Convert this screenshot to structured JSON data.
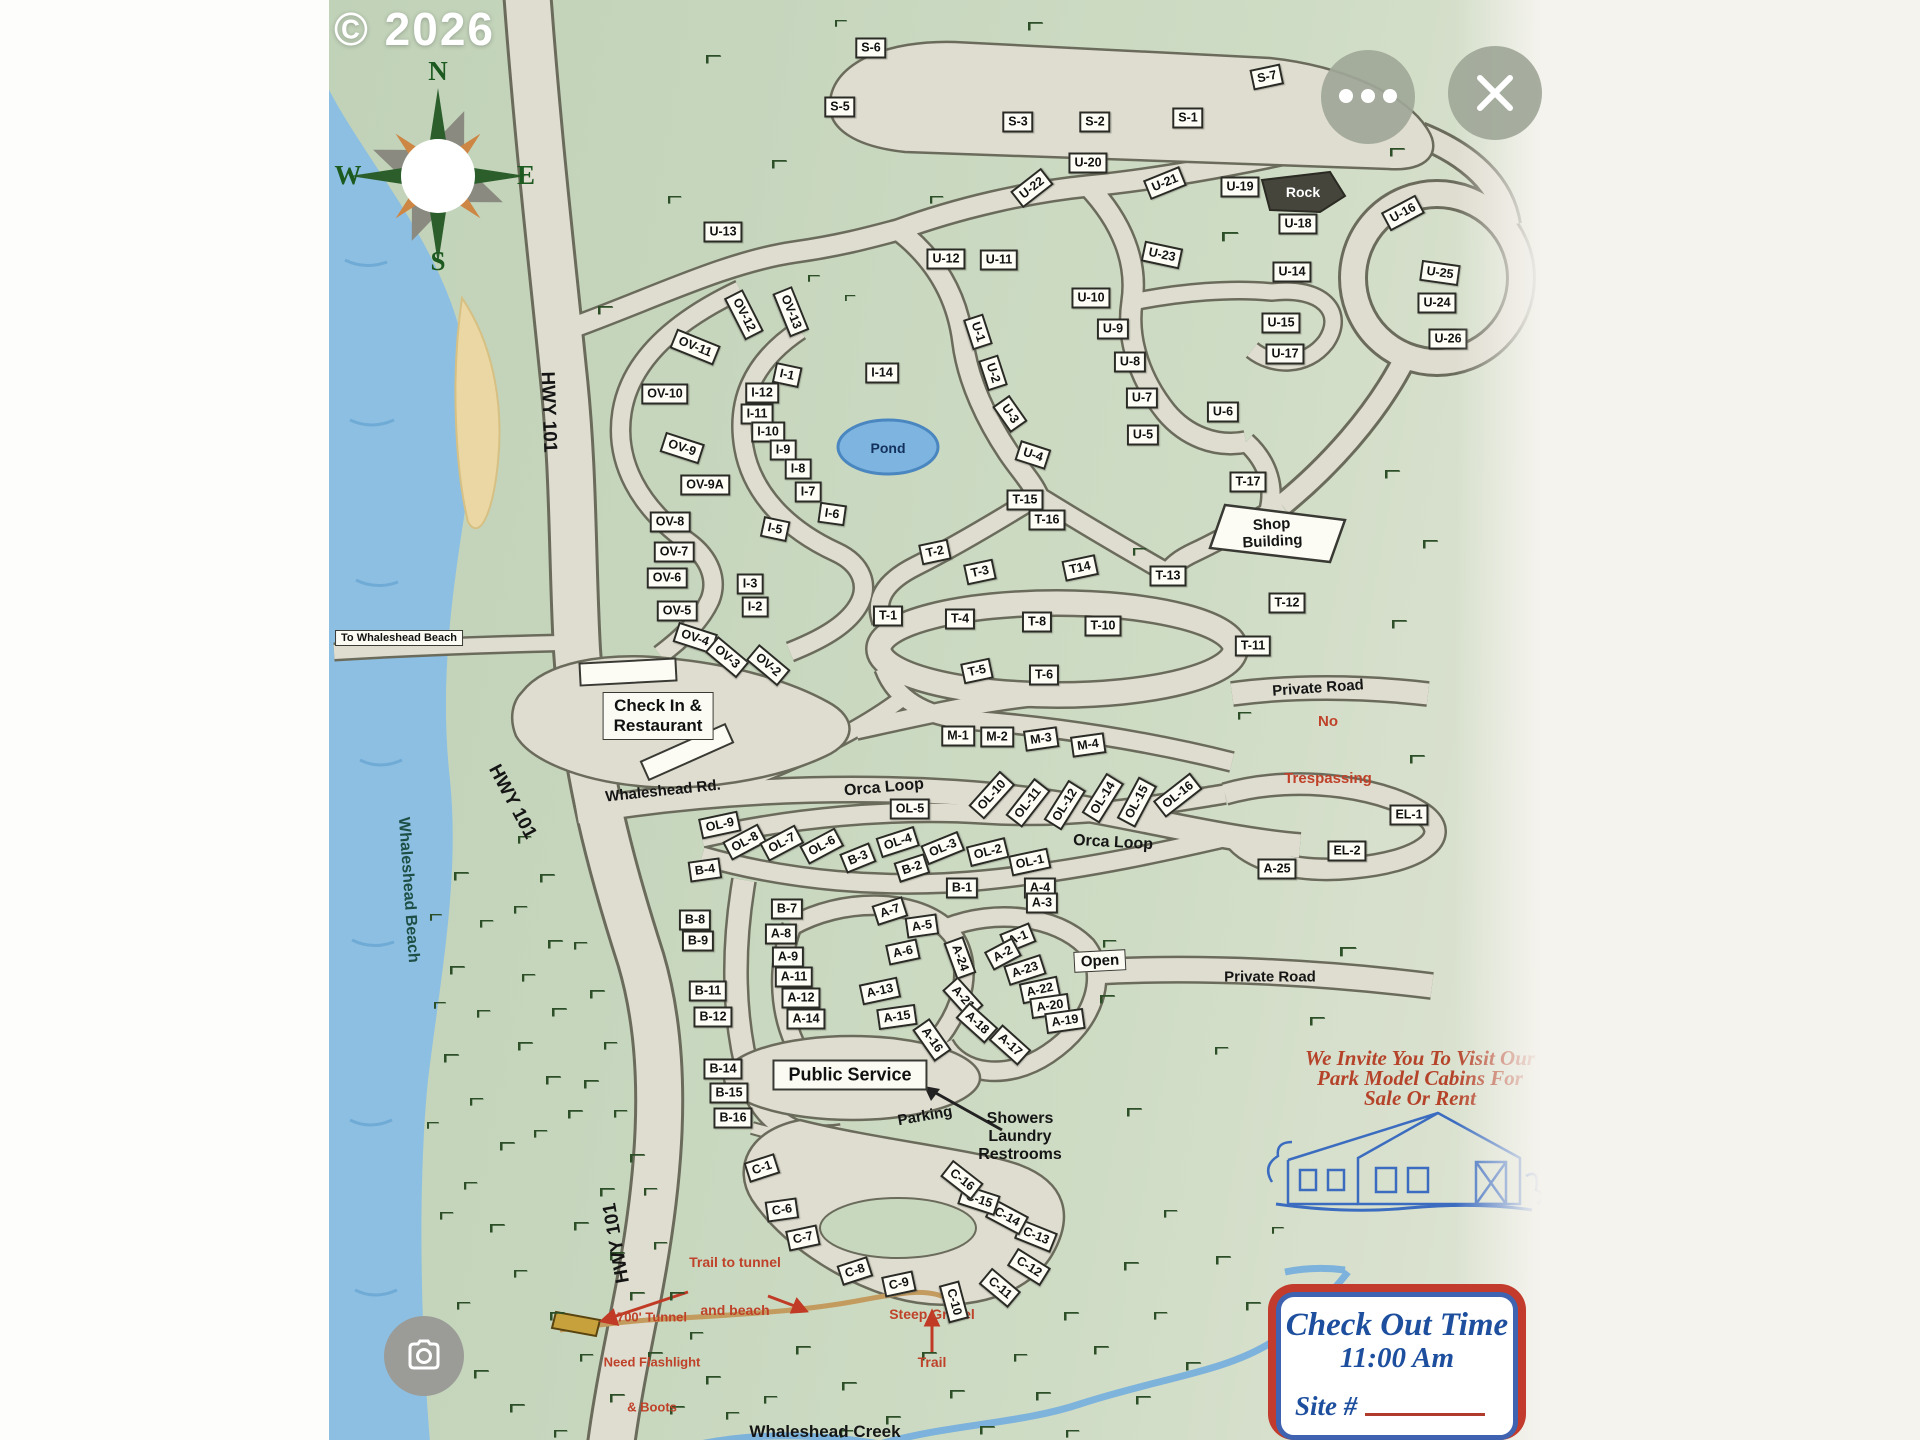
{
  "watermark": "© 2026",
  "compass": {
    "n": "N",
    "e": "E",
    "s": "S",
    "w": "W"
  },
  "labels": {
    "hwy101_a": "HWY 101",
    "hwy101_b": "HWY 101",
    "hwy101_c": "HWY 101",
    "to_beach": "To Whaleshead Beach",
    "beach": "Whaleshead Beach",
    "whaleshead_rd": "Whaleshead Rd.",
    "orca_loop_a": "Orca Loop",
    "orca_loop_b": "Orca Loop",
    "pond": "Pond",
    "rock": "Rock",
    "private_road_a": "Private Road",
    "private_road_b": "Private Road",
    "open": "Open",
    "parking": "Parking",
    "public_service": "Public Service",
    "creek": "Whaleshead Creek",
    "checkin_lines": [
      "Check In &",
      "Restaurant"
    ],
    "shop_lines": [
      "Shop",
      "Building"
    ],
    "no_trespassing_lines": [
      "No",
      "Trespassing"
    ],
    "showers_lines": [
      "Showers",
      "Laundry",
      "Restrooms"
    ],
    "trail_lines": [
      "Trail to tunnel",
      "and beach"
    ],
    "tunnel_lines": [
      "700' Tunnel",
      "Need Flashlight",
      "& Boots"
    ],
    "steep_lines": [
      "Steep Gravel",
      "Trail"
    ],
    "invite_lines": [
      "We Invite You To Visit Our",
      "Park Model Cabins For",
      "Sale Or Rent"
    ],
    "checkout_title": "Check Out Time",
    "checkout_time": "11:00 Am",
    "site_no": "Site #"
  },
  "sites": [
    {
      "l": "S-6",
      "x": 871,
      "y": 48
    },
    {
      "l": "S-5",
      "x": 840,
      "y": 107
    },
    {
      "l": "S-3",
      "x": 1018,
      "y": 122
    },
    {
      "l": "S-2",
      "x": 1095,
      "y": 122
    },
    {
      "l": "S-1",
      "x": 1188,
      "y": 118
    },
    {
      "l": "S-7",
      "x": 1267,
      "y": 77,
      "r": -12
    },
    {
      "l": "U-20",
      "x": 1088,
      "y": 163
    },
    {
      "l": "U-22",
      "x": 1032,
      "y": 188,
      "r": -38
    },
    {
      "l": "U-21",
      "x": 1165,
      "y": 183,
      "r": -22
    },
    {
      "l": "U-19",
      "x": 1240,
      "y": 187
    },
    {
      "l": "U-18",
      "x": 1298,
      "y": 224
    },
    {
      "l": "U-16",
      "x": 1403,
      "y": 213,
      "r": -28
    },
    {
      "l": "U-13",
      "x": 723,
      "y": 232
    },
    {
      "l": "U-12",
      "x": 946,
      "y": 259
    },
    {
      "l": "U-11",
      "x": 999,
      "y": 260
    },
    {
      "l": "U-23",
      "x": 1162,
      "y": 255,
      "r": 12
    },
    {
      "l": "U-14",
      "x": 1292,
      "y": 272
    },
    {
      "l": "U-25",
      "x": 1440,
      "y": 273,
      "r": 8
    },
    {
      "l": "U-10",
      "x": 1091,
      "y": 298
    },
    {
      "l": "U-24",
      "x": 1437,
      "y": 303
    },
    {
      "l": "U-15",
      "x": 1281,
      "y": 323
    },
    {
      "l": "U-9",
      "x": 1113,
      "y": 329
    },
    {
      "l": "U-26",
      "x": 1448,
      "y": 339
    },
    {
      "l": "U-1",
      "x": 978,
      "y": 332,
      "r": 72
    },
    {
      "l": "U-17",
      "x": 1285,
      "y": 354
    },
    {
      "l": "U-8",
      "x": 1130,
      "y": 362
    },
    {
      "l": "U-2",
      "x": 993,
      "y": 373,
      "r": 72
    },
    {
      "l": "U-7",
      "x": 1142,
      "y": 398
    },
    {
      "l": "U-3",
      "x": 1010,
      "y": 414,
      "r": 55
    },
    {
      "l": "U-6",
      "x": 1223,
      "y": 412
    },
    {
      "l": "U-5",
      "x": 1143,
      "y": 435
    },
    {
      "l": "U-4",
      "x": 1033,
      "y": 455,
      "r": 18
    },
    {
      "l": "OV-12",
      "x": 744,
      "y": 315,
      "r": 63
    },
    {
      "l": "OV-13",
      "x": 791,
      "y": 312,
      "r": 68
    },
    {
      "l": "OV-11",
      "x": 695,
      "y": 347,
      "r": 22
    },
    {
      "l": "OV-10",
      "x": 665,
      "y": 394
    },
    {
      "l": "OV-9",
      "x": 682,
      "y": 448,
      "r": 18
    },
    {
      "l": "OV-9A",
      "x": 705,
      "y": 485
    },
    {
      "l": "OV-8",
      "x": 670,
      "y": 522
    },
    {
      "l": "OV-7",
      "x": 674,
      "y": 552
    },
    {
      "l": "OV-6",
      "x": 667,
      "y": 578
    },
    {
      "l": "OV-5",
      "x": 677,
      "y": 611
    },
    {
      "l": "OV-4",
      "x": 695,
      "y": 638,
      "r": 18
    },
    {
      "l": "OV-3",
      "x": 727,
      "y": 657,
      "r": 40
    },
    {
      "l": "OV-2",
      "x": 768,
      "y": 665,
      "r": 40
    },
    {
      "l": "I-1",
      "x": 787,
      "y": 375,
      "r": 12
    },
    {
      "l": "I-14",
      "x": 882,
      "y": 373
    },
    {
      "l": "I-12",
      "x": 762,
      "y": 393
    },
    {
      "l": "I-11",
      "x": 757,
      "y": 414
    },
    {
      "l": "I-10",
      "x": 768,
      "y": 432
    },
    {
      "l": "I-9",
      "x": 783,
      "y": 450
    },
    {
      "l": "I-8",
      "x": 798,
      "y": 469
    },
    {
      "l": "I-7",
      "x": 808,
      "y": 492
    },
    {
      "l": "I-6",
      "x": 832,
      "y": 514,
      "r": 8
    },
    {
      "l": "I-5",
      "x": 775,
      "y": 529,
      "r": 12
    },
    {
      "l": "I-3",
      "x": 750,
      "y": 584
    },
    {
      "l": "I-2",
      "x": 755,
      "y": 607
    },
    {
      "l": "T-15",
      "x": 1025,
      "y": 500
    },
    {
      "l": "T-16",
      "x": 1047,
      "y": 520
    },
    {
      "l": "T-17",
      "x": 1248,
      "y": 482
    },
    {
      "l": "T-2",
      "x": 935,
      "y": 552,
      "r": -12
    },
    {
      "l": "T-3",
      "x": 980,
      "y": 572,
      "r": -12
    },
    {
      "l": "T14",
      "x": 1080,
      "y": 568,
      "r": -12
    },
    {
      "l": "T-13",
      "x": 1168,
      "y": 576
    },
    {
      "l": "T-12",
      "x": 1287,
      "y": 603
    },
    {
      "l": "T-1",
      "x": 888,
      "y": 616
    },
    {
      "l": "T-4",
      "x": 960,
      "y": 619
    },
    {
      "l": "T-8",
      "x": 1037,
      "y": 622
    },
    {
      "l": "T-10",
      "x": 1103,
      "y": 626
    },
    {
      "l": "T-11",
      "x": 1253,
      "y": 646
    },
    {
      "l": "T-5",
      "x": 977,
      "y": 671,
      "r": -12
    },
    {
      "l": "T-6",
      "x": 1044,
      "y": 675
    },
    {
      "l": "M-1",
      "x": 958,
      "y": 736
    },
    {
      "l": "M-2",
      "x": 997,
      "y": 737
    },
    {
      "l": "M-3",
      "x": 1041,
      "y": 739,
      "r": -8
    },
    {
      "l": "M-4",
      "x": 1088,
      "y": 745,
      "r": -8
    },
    {
      "l": "OL-9",
      "x": 720,
      "y": 825,
      "r": -12
    },
    {
      "l": "OL-8",
      "x": 745,
      "y": 842,
      "r": -28
    },
    {
      "l": "OL-7",
      "x": 782,
      "y": 843,
      "r": -28
    },
    {
      "l": "OL-6",
      "x": 822,
      "y": 846,
      "r": -28
    },
    {
      "l": "OL-5",
      "x": 910,
      "y": 809
    },
    {
      "l": "OL-4",
      "x": 898,
      "y": 842,
      "r": -18
    },
    {
      "l": "OL-3",
      "x": 943,
      "y": 848,
      "r": -22
    },
    {
      "l": "OL-2",
      "x": 988,
      "y": 852,
      "r": -14
    },
    {
      "l": "OL-1",
      "x": 1030,
      "y": 862,
      "r": -12
    },
    {
      "l": "OL-10",
      "x": 992,
      "y": 795,
      "r": -48
    },
    {
      "l": "OL-11",
      "x": 1028,
      "y": 803,
      "r": -52
    },
    {
      "l": "OL-12",
      "x": 1065,
      "y": 805,
      "r": -58
    },
    {
      "l": "OL-14",
      "x": 1103,
      "y": 798,
      "r": -58
    },
    {
      "l": "OL-15",
      "x": 1137,
      "y": 802,
      "r": -62
    },
    {
      "l": "OL-16",
      "x": 1178,
      "y": 795,
      "r": -38
    },
    {
      "l": "B-4",
      "x": 705,
      "y": 870,
      "r": -8
    },
    {
      "l": "B-3",
      "x": 858,
      "y": 858,
      "r": -22
    },
    {
      "l": "B-2",
      "x": 912,
      "y": 868,
      "r": -18
    },
    {
      "l": "B-1",
      "x": 962,
      "y": 888
    },
    {
      "l": "B-7",
      "x": 787,
      "y": 909
    },
    {
      "l": "B-8",
      "x": 695,
      "y": 920
    },
    {
      "l": "B-9",
      "x": 698,
      "y": 941
    },
    {
      "l": "B-11",
      "x": 708,
      "y": 991
    },
    {
      "l": "B-12",
      "x": 713,
      "y": 1017
    },
    {
      "l": "B-14",
      "x": 723,
      "y": 1069
    },
    {
      "l": "B-15",
      "x": 729,
      "y": 1093
    },
    {
      "l": "B-16",
      "x": 733,
      "y": 1118
    },
    {
      "l": "A-4",
      "x": 1040,
      "y": 888
    },
    {
      "l": "A-3",
      "x": 1042,
      "y": 903
    },
    {
      "l": "A-7",
      "x": 890,
      "y": 911,
      "r": -18
    },
    {
      "l": "A-5",
      "x": 922,
      "y": 926,
      "r": -8
    },
    {
      "l": "A-8",
      "x": 781,
      "y": 934
    },
    {
      "l": "A-6",
      "x": 903,
      "y": 952,
      "r": -12
    },
    {
      "l": "A-9",
      "x": 788,
      "y": 957
    },
    {
      "l": "A-1",
      "x": 1018,
      "y": 938,
      "r": -22
    },
    {
      "l": "A-2",
      "x": 1003,
      "y": 954,
      "r": -28
    },
    {
      "l": "A-24",
      "x": 960,
      "y": 958,
      "r": 70
    },
    {
      "l": "A-11",
      "x": 794,
      "y": 977
    },
    {
      "l": "A-23",
      "x": 1025,
      "y": 970,
      "r": -18
    },
    {
      "l": "A-13",
      "x": 880,
      "y": 991,
      "r": -12
    },
    {
      "l": "A-22",
      "x": 1040,
      "y": 990,
      "r": -12
    },
    {
      "l": "A-12",
      "x": 801,
      "y": 998
    },
    {
      "l": "A-21",
      "x": 963,
      "y": 998,
      "r": 48
    },
    {
      "l": "A-20",
      "x": 1050,
      "y": 1006,
      "r": -8
    },
    {
      "l": "A-15",
      "x": 897,
      "y": 1017,
      "r": -8
    },
    {
      "l": "A-14",
      "x": 806,
      "y": 1019
    },
    {
      "l": "A-19",
      "x": 1065,
      "y": 1021,
      "r": -8
    },
    {
      "l": "A-18",
      "x": 977,
      "y": 1023,
      "r": 42
    },
    {
      "l": "A-16",
      "x": 932,
      "y": 1040,
      "r": 55
    },
    {
      "l": "A-17",
      "x": 1010,
      "y": 1045,
      "r": 42
    },
    {
      "l": "A-25",
      "x": 1277,
      "y": 869
    },
    {
      "l": "EL-1",
      "x": 1409,
      "y": 815
    },
    {
      "l": "EL-2",
      "x": 1347,
      "y": 851
    },
    {
      "l": "C-1",
      "x": 762,
      "y": 1168,
      "r": -18
    },
    {
      "l": "C-6",
      "x": 782,
      "y": 1210,
      "r": -8
    },
    {
      "l": "C-7",
      "x": 803,
      "y": 1238,
      "r": -12
    },
    {
      "l": "C-8",
      "x": 855,
      "y": 1271,
      "r": -18
    },
    {
      "l": "C-9",
      "x": 899,
      "y": 1284,
      "r": -12
    },
    {
      "l": "C-10",
      "x": 954,
      "y": 1302,
      "r": 75
    },
    {
      "l": "C-11",
      "x": 1000,
      "y": 1288,
      "r": 40
    },
    {
      "l": "C-12",
      "x": 1029,
      "y": 1267,
      "r": 32
    },
    {
      "l": "C-13",
      "x": 1036,
      "y": 1236,
      "r": 22
    },
    {
      "l": "C-14",
      "x": 1007,
      "y": 1217,
      "r": 28
    },
    {
      "l": "C-15",
      "x": 979,
      "y": 1200,
      "r": 18
    },
    {
      "l": "C-16",
      "x": 962,
      "y": 1180,
      "r": 38
    }
  ],
  "trees": [
    [
      706,
      55,
      1
    ],
    [
      772,
      160,
      1
    ],
    [
      668,
      196,
      0.9
    ],
    [
      1028,
      22,
      1
    ],
    [
      835,
      20,
      0.8
    ],
    [
      930,
      196,
      0.9
    ],
    [
      1185,
      120,
      1
    ],
    [
      1390,
      148,
      1
    ],
    [
      1222,
      232,
      1.1
    ],
    [
      598,
      306,
      1
    ],
    [
      808,
      275,
      0.8
    ],
    [
      845,
      295,
      0.7
    ],
    [
      1133,
      548,
      0.9
    ],
    [
      1385,
      470,
      1
    ],
    [
      1423,
      540,
      1
    ],
    [
      1392,
      620,
      1
    ],
    [
      1238,
      712,
      0.9
    ],
    [
      1410,
      755,
      1
    ],
    [
      1103,
      940,
      0.9
    ],
    [
      1100,
      995,
      1
    ],
    [
      1215,
      1047,
      0.9
    ],
    [
      1340,
      947,
      1.1
    ],
    [
      1310,
      1017,
      1
    ],
    [
      1127,
      1108,
      1
    ],
    [
      1272,
      1227,
      0.8
    ],
    [
      518,
      836,
      0.9
    ],
    [
      540,
      874,
      1
    ],
    [
      514,
      906,
      0.9
    ],
    [
      548,
      940,
      1
    ],
    [
      522,
      974,
      0.9
    ],
    [
      552,
      1008,
      1
    ],
    [
      518,
      1042,
      1
    ],
    [
      546,
      1076,
      1
    ],
    [
      568,
      1110,
      1
    ],
    [
      534,
      1130,
      0.9
    ],
    [
      574,
      942,
      0.9
    ],
    [
      590,
      990,
      1
    ],
    [
      604,
      1042,
      0.9
    ],
    [
      584,
      1080,
      1
    ],
    [
      614,
      1110,
      0.9
    ],
    [
      630,
      1154,
      1
    ],
    [
      600,
      1188,
      1
    ],
    [
      644,
      1188,
      0.9
    ],
    [
      574,
      1222,
      1
    ],
    [
      610,
      1252,
      1
    ],
    [
      654,
      1242,
      0.9
    ],
    [
      630,
      1292,
      1
    ],
    [
      670,
      1292,
      1
    ],
    [
      690,
      1332,
      0.9
    ],
    [
      648,
      1352,
      1
    ],
    [
      706,
      1376,
      1
    ],
    [
      670,
      1406,
      1
    ],
    [
      726,
      1412,
      0.9
    ],
    [
      764,
      1396,
      0.9
    ],
    [
      610,
      1394,
      1
    ],
    [
      580,
      1354,
      0.9
    ],
    [
      550,
      1312,
      1
    ],
    [
      514,
      1270,
      0.9
    ],
    [
      490,
      1224,
      1
    ],
    [
      464,
      1182,
      0.9
    ],
    [
      500,
      1142,
      1
    ],
    [
      470,
      1098,
      0.9
    ],
    [
      444,
      1054,
      1
    ],
    [
      477,
      1010,
      0.9
    ],
    [
      450,
      966,
      1
    ],
    [
      480,
      920,
      0.9
    ],
    [
      454,
      872,
      1
    ],
    [
      430,
      914,
      0.8
    ],
    [
      434,
      1002,
      0.8
    ],
    [
      427,
      1122,
      0.8
    ],
    [
      440,
      1212,
      0.9
    ],
    [
      457,
      1302,
      0.9
    ],
    [
      474,
      1370,
      1
    ],
    [
      510,
      1404,
      1
    ],
    [
      554,
      1430,
      0.9
    ],
    [
      796,
      1346,
      1
    ],
    [
      842,
      1382,
      1
    ],
    [
      886,
      1416,
      1
    ],
    [
      840,
      1430,
      0.9
    ],
    [
      922,
      1352,
      1
    ],
    [
      950,
      1390,
      1
    ],
    [
      980,
      1426,
      1
    ],
    [
      1014,
      1354,
      0.9
    ],
    [
      1036,
      1392,
      1
    ],
    [
      1064,
      1312,
      1
    ],
    [
      1094,
      1346,
      1
    ],
    [
      1124,
      1262,
      1
    ],
    [
      1136,
      1396,
      1
    ],
    [
      1154,
      1312,
      0.9
    ],
    [
      1186,
      1362,
      1
    ],
    [
      1216,
      1256,
      1
    ],
    [
      1246,
      1302,
      1
    ],
    [
      1164,
      1210,
      0.9
    ],
    [
      1066,
      1430,
      0.9
    ]
  ]
}
